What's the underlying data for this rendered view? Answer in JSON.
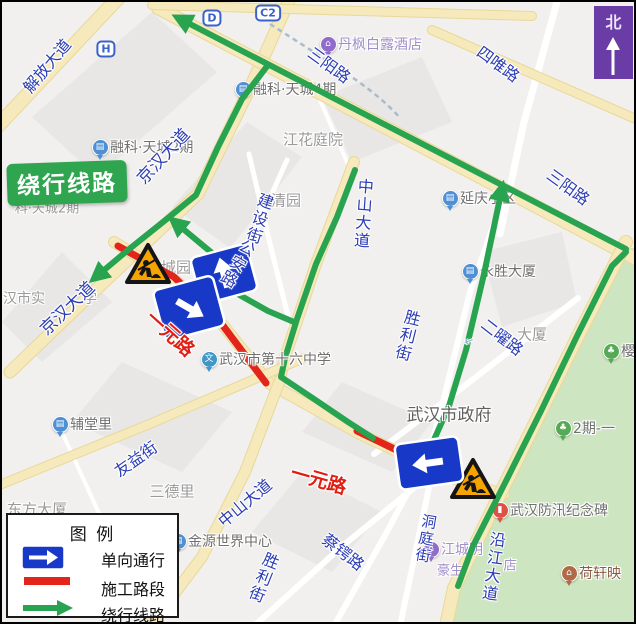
{
  "badge": {
    "text": "绕行线路"
  },
  "compass": {
    "label": "北"
  },
  "legend": {
    "title": "图  例",
    "items": [
      {
        "type": "oneway",
        "label": "单向通行"
      },
      {
        "type": "construction",
        "label": "施工路段"
      },
      {
        "type": "detour",
        "label": "绕行线路"
      }
    ]
  },
  "colors": {
    "detour_green": "#28a34f",
    "construction_red": "#e2241a",
    "oneway_sign_blue": "#1838c8",
    "road_label_blue": "#2b3cb5",
    "road_label_red": "#e01f14",
    "area_label_gray": "#9a9a9a",
    "poi_text_gray": "#707070",
    "park_green": "#cde5c0",
    "main_road_yellow": "#f6e9bb",
    "compass_purple": "#6a3ca5"
  },
  "map": {
    "road_labels": [
      {
        "text": "解放大道",
        "x": 44,
        "y": 63,
        "rot": -50,
        "size": 16
      },
      {
        "text": "京汉大道",
        "x": 160,
        "y": 153,
        "rot": -47,
        "size": 17
      },
      {
        "text": "京汉大道",
        "x": 64,
        "y": 305,
        "rot": -44,
        "size": 17
      },
      {
        "text": "三阳路",
        "x": 328,
        "y": 62,
        "rot": 36,
        "size": 16
      },
      {
        "text": "三阳路",
        "x": 567,
        "y": 184,
        "rot": 36,
        "size": 16
      },
      {
        "text": "四唯路",
        "x": 497,
        "y": 61,
        "rot": 36,
        "size": 16
      },
      {
        "text": "中山大道",
        "x": 362,
        "y": 212,
        "rot": 4,
        "size": 16,
        "vertical": true
      },
      {
        "text": "中山大道",
        "x": 242,
        "y": 500,
        "rot": -40,
        "size": 16
      },
      {
        "text": "建设街",
        "x": 258,
        "y": 217,
        "rot": 18,
        "size": 16,
        "vertical": true
      },
      {
        "text": "公安路",
        "x": 236,
        "y": 262,
        "rot": 30,
        "size": 16,
        "vertical": true
      },
      {
        "text": "胜利街",
        "x": 406,
        "y": 334,
        "rot": 14,
        "size": 16,
        "vertical": true
      },
      {
        "text": "胜利街",
        "x": 262,
        "y": 576,
        "rot": 22,
        "size": 16,
        "vertical": true
      },
      {
        "text": "二曜路",
        "x": 501,
        "y": 334,
        "rot": 38,
        "size": 16
      },
      {
        "text": "沿江大道",
        "x": 492,
        "y": 565,
        "rot": 8,
        "size": 16,
        "vertical": true
      },
      {
        "text": "洞庭街",
        "x": 424,
        "y": 537,
        "rot": 10,
        "size": 15,
        "vertical": true
      },
      {
        "text": "蔡锷路",
        "x": 342,
        "y": 549,
        "rot": 38,
        "size": 16
      },
      {
        "text": "友益街",
        "x": 133,
        "y": 456,
        "rot": -35,
        "size": 16
      },
      {
        "text": "一元路",
        "x": 169,
        "y": 331,
        "rot": 42,
        "size": 19,
        "color": "#e01f14",
        "bold": true
      },
      {
        "text": "一元路",
        "x": 317,
        "y": 477,
        "rot": 16,
        "size": 19,
        "color": "#e01f14",
        "bold": true
      },
      {
        "text": "←",
        "x": 467,
        "y": 339,
        "rot": -20,
        "size": 11,
        "color": "#8aa4d6"
      }
    ],
    "area_labels": [
      {
        "text": "江花庭院",
        "x": 311,
        "y": 137,
        "size": 15
      },
      {
        "text": "清园",
        "x": 284,
        "y": 198,
        "size": 15
      },
      {
        "text": "城园",
        "x": 174,
        "y": 265,
        "size": 15
      },
      {
        "text": "三德里",
        "x": 170,
        "y": 489,
        "size": 15
      },
      {
        "text": "汉市实",
        "x": 22,
        "y": 296,
        "size": 14
      },
      {
        "text": "学",
        "x": 88,
        "y": 296,
        "size": 14
      },
      {
        "text": "科·天城2期",
        "x": 45,
        "y": 205,
        "size": 13
      },
      {
        "text": "大厦",
        "x": 530,
        "y": 332,
        "size": 15
      },
      {
        "text": "东方大厦",
        "x": 35,
        "y": 507,
        "size": 15
      },
      {
        "text": "豪生",
        "x": 448,
        "y": 567,
        "size": 13,
        "color": "#a08fc9"
      },
      {
        "text": "店",
        "x": 508,
        "y": 562,
        "size": 13,
        "color": "#a08fc9"
      },
      {
        "text": "武汉市政府",
        "x": 447,
        "y": 411,
        "size": 17,
        "color": "#5f5f5f",
        "top": true
      }
    ],
    "poi": [
      {
        "text": "融科·天城4期",
        "x": 240,
        "y": 88,
        "icon": "building",
        "icon_color": "#4f8fd4"
      },
      {
        "text": "融科·天城2期",
        "x": 97,
        "y": 146,
        "icon": "building",
        "icon_color": "#4f8fd4"
      },
      {
        "text": "丹枫白露酒店",
        "x": 325,
        "y": 43,
        "icon": "hotel",
        "icon_color": "#8f6cc9",
        "text_color": "#a08fc9"
      },
      {
        "text": "延庆小区",
        "x": 447,
        "y": 197,
        "icon": "building",
        "icon_color": "#4f8fd4"
      },
      {
        "text": "永胜大厦",
        "x": 467,
        "y": 270,
        "icon": "building",
        "icon_color": "#4f8fd4"
      },
      {
        "text": "樱园",
        "x": 608,
        "y": 350,
        "icon": "tree",
        "icon_color": "#55ab55"
      },
      {
        "text": "2期-一",
        "x": 560,
        "y": 427,
        "icon": "tree",
        "icon_color": "#55ab55"
      },
      {
        "text": "武汉防汛纪念碑",
        "x": 497,
        "y": 509,
        "icon": "monument",
        "icon_color": "#df5146"
      },
      {
        "text": "荷轩映",
        "x": 566,
        "y": 572,
        "icon": "hotel",
        "icon_color": "#b06a48",
        "text_color": "#8a5b47"
      },
      {
        "text": "江城明",
        "x": 428,
        "y": 548,
        "icon": "hotel",
        "icon_color": "#8f6cc9",
        "text_color": "#a08fc9"
      },
      {
        "text": "武汉市第十六中学",
        "x": 206,
        "y": 358,
        "icon": "school",
        "icon_color": "#3e97c8",
        "top": true
      },
      {
        "text": "辅堂里",
        "x": 57,
        "y": 423,
        "icon": "building",
        "icon_color": "#4f8fd4"
      },
      {
        "text": "金源世界中心",
        "x": 175,
        "y": 540,
        "icon": "building",
        "icon_color": "#4f8fd4"
      }
    ],
    "metro_badges": [
      {
        "text": "H",
        "x": 104,
        "y": 47
      },
      {
        "text": "D",
        "x": 210,
        "y": 16
      },
      {
        "text": "C2",
        "x": 266,
        "y": 11
      }
    ],
    "detour_routes": [
      {
        "name": "sanyang-road",
        "arrow": true,
        "points": [
          [
            624,
            247
          ],
          [
            186,
            21
          ]
        ]
      },
      {
        "name": "jianghan-avenue",
        "arrow": true,
        "points": [
          [
            266,
            63
          ],
          [
            240,
            97
          ],
          [
            216,
            145
          ],
          [
            194,
            193
          ],
          [
            166,
            216
          ],
          [
            126,
            248
          ],
          [
            101,
            269
          ]
        ]
      },
      {
        "name": "turn-onto-jianghan",
        "arrow": true,
        "points": [
          [
            238,
            274
          ],
          [
            204,
            246
          ],
          [
            180,
            226
          ]
        ]
      },
      {
        "name": "zhongshan-avenue",
        "arrow": false,
        "points": [
          [
            353,
            168
          ],
          [
            335,
            215
          ],
          [
            314,
            262
          ],
          [
            295,
            317
          ],
          [
            283,
            356
          ],
          [
            279,
            375
          ],
          [
            312,
            397
          ],
          [
            346,
            420
          ],
          [
            371,
            436
          ]
        ]
      },
      {
        "name": "gongan-link",
        "arrow": false,
        "points": [
          [
            234,
            291
          ],
          [
            266,
            309
          ],
          [
            292,
            320
          ]
        ]
      },
      {
        "name": "shengli-street",
        "arrow": true,
        "points": [
          [
            431,
            440
          ],
          [
            447,
            404
          ],
          [
            464,
            348
          ],
          [
            482,
            272
          ],
          [
            498,
            196
          ]
        ]
      },
      {
        "name": "yanjiang-avenue",
        "arrow": false,
        "points": [
          [
            624,
            250
          ],
          [
            610,
            264
          ],
          [
            576,
            332
          ],
          [
            539,
            409
          ],
          [
            504,
            479
          ],
          [
            471,
            544
          ],
          [
            456,
            584
          ]
        ]
      }
    ],
    "construction_segments": [
      {
        "name": "yiyuan-road-west",
        "points": [
          [
            116,
            244
          ],
          [
            172,
            275
          ],
          [
            219,
            321
          ],
          [
            264,
            381
          ]
        ]
      },
      {
        "name": "yiyuan-road-east",
        "points": [
          [
            355,
            429
          ],
          [
            463,
            481
          ]
        ]
      }
    ],
    "oneway_signs": [
      {
        "name": "oneway-sign-up",
        "x": 222,
        "y": 272,
        "w": 58,
        "h": 48,
        "rot": -15,
        "arrow": "up"
      },
      {
        "name": "oneway-sign-down-right",
        "x": 187,
        "y": 306,
        "w": 62,
        "h": 52,
        "rot": -15,
        "arrow": "down-right"
      },
      {
        "name": "oneway-sign-left",
        "x": 427,
        "y": 461,
        "w": 64,
        "h": 46,
        "rot": -8,
        "arrow": "left"
      }
    ],
    "construction_icons": [
      {
        "name": "construction-icon-west",
        "x": 146,
        "y": 262,
        "size": 46
      },
      {
        "name": "construction-icon-east",
        "x": 471,
        "y": 477,
        "size": 50
      }
    ]
  }
}
